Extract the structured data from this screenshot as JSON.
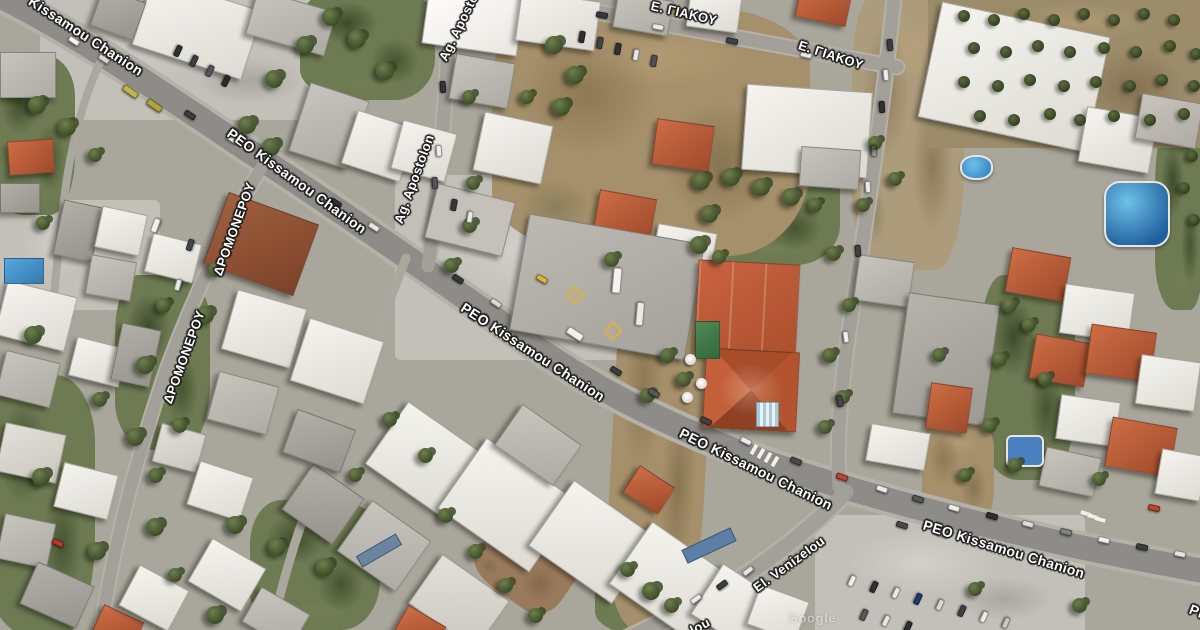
{
  "map": {
    "description": "Satellite aerial view of Chania street network",
    "labels": {
      "kissamou_nw": {
        "text": "Kissamou Chanion"
      },
      "peo_1": {
        "text": "PEO Kissamou Chanion"
      },
      "peo_2": {
        "text": "PEO Kissamou Chanion"
      },
      "peo_3": {
        "text": "PEO Kissamou Chanion"
      },
      "peo_4": {
        "text": "PEO Kissamou Chanion"
      },
      "peo_fragment": {
        "text": "PE"
      },
      "giakou_1": {
        "text": "Ε. ΓΙΑΚΟΥ"
      },
      "giakou_2": {
        "text": "Ε. ΓΙΑΚΟΥ"
      },
      "apostolon_1": {
        "text": "Ag. Apostolon"
      },
      "apostolon_2": {
        "text": "Ag. Apostolon"
      },
      "dromonerou_1": {
        "text": "ΔΡΟΜΟΝΕΡΟΥ"
      },
      "dromonerou_2": {
        "text": "ΔΡΟΜΟΝΕΡΟΥ"
      },
      "venizelou": {
        "text": "El. Venizelou"
      },
      "venizelou_fragment": {
        "text": "lou"
      }
    },
    "watermark": "Google",
    "palette": {
      "road_label_text": "#ffffff",
      "road_label_outline": "#1c1c1c",
      "asphalt": "#8e8c88",
      "concrete": "#c3c0b9",
      "dirt": "#a5906b",
      "vegetation": "#6e7a52",
      "roof_white": "#f2f1ec",
      "roof_terracotta": "#bb5c38",
      "pool_blue": "#3f8fcc"
    }
  }
}
